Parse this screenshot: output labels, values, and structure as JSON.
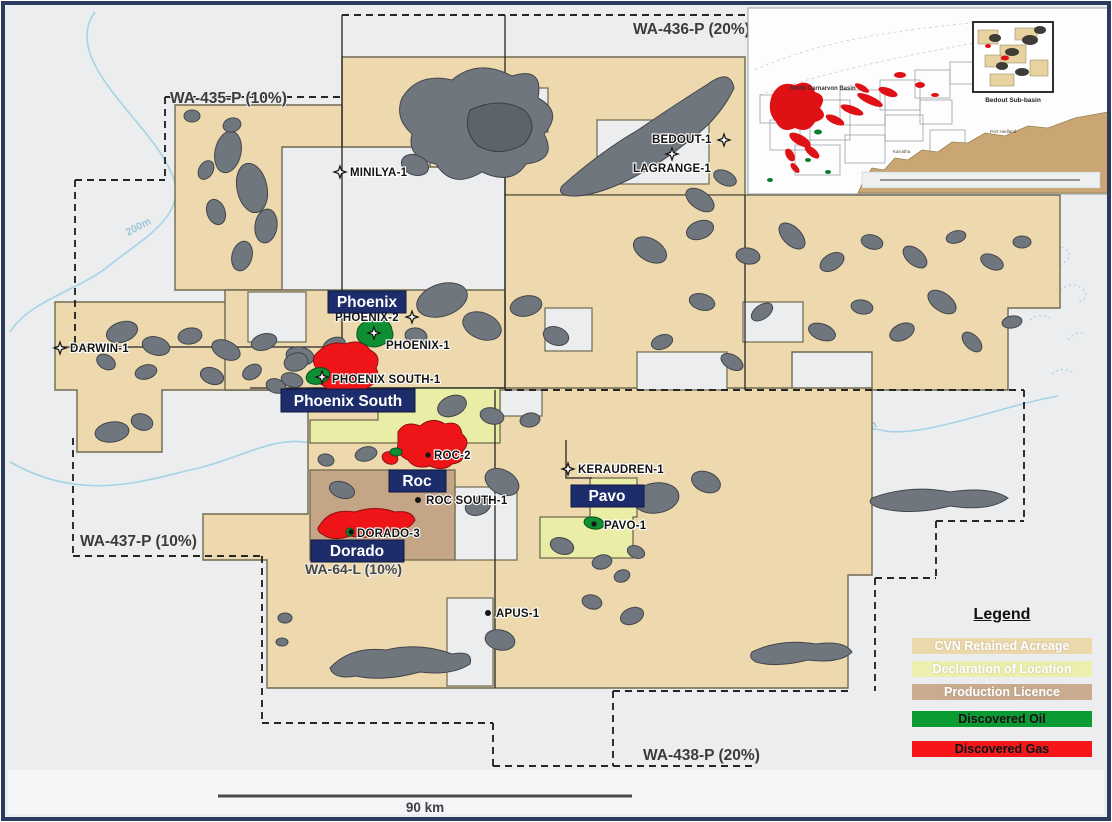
{
  "map": {
    "licences": {
      "wa435": "WA-435-P (10%)",
      "wa436": "WA-436-P (20%)",
      "wa437": "WA-437-P (10%)",
      "wa438": "WA-438-P (20%)",
      "wa64l": "WA-64-L (10%)"
    },
    "fields": {
      "phoenix": "Phoenix",
      "phoenix_south": "Phoenix South",
      "roc": "Roc",
      "dorado": "Dorado",
      "pavo": "Pavo"
    },
    "wells": {
      "minilya": "MINILYA-1",
      "bedout": "BEDOUT-1",
      "lagrange": "LAGRANGE-1",
      "darwin": "DARWIN-1",
      "phoenix2": "PHOENIX-2",
      "phoenix1": "PHOENIX-1",
      "phoenix_south1": "PHOENIX SOUTH-1",
      "roc2": "ROC-2",
      "roc_south1": "ROC SOUTH-1",
      "dorado3": "DORADO-3",
      "keraudren": "KERAUDREN-1",
      "pavo1": "PAVO-1",
      "apus": "APUS-1"
    },
    "contours": {
      "c200": "200m",
      "c100": "100m"
    },
    "scale": {
      "label": "90 km"
    }
  },
  "inset": {
    "basin": "North Carnarvon Basin",
    "box_label": "Bedout Sub-basin",
    "towns": {
      "karratha": "Karratha",
      "port_hedland": "Port Hedland"
    }
  },
  "legend": {
    "title": "Legend",
    "items": [
      {
        "label": "CVN Retained Acreage",
        "style": "background:#ecd9ab;color:#ffffff"
      },
      {
        "label": "Declaration of Location",
        "style": "background:#edefae;color:#ffffff"
      },
      {
        "label": "Production Licence",
        "style": "background:#c9ac8d;color:#ffffff"
      },
      {
        "label": "Discovered Oil",
        "style": "background:#0a9b32;color:#111111;margin-top:11px"
      },
      {
        "label": "Discovered Gas",
        "style": "background:#f61519;color:#111111;margin-top:14px"
      }
    ]
  },
  "colors": {
    "retained_acreage": "#ecd9ab",
    "declaration_of_location": "#edefae",
    "production_licence": "#c9ac8d",
    "discovered_oil": "#0a9b32",
    "discovered_gas": "#f61519",
    "field_label_bg": "#1d2d6b",
    "amplitude_gray": "#70767d",
    "sea": "#ebedee"
  }
}
